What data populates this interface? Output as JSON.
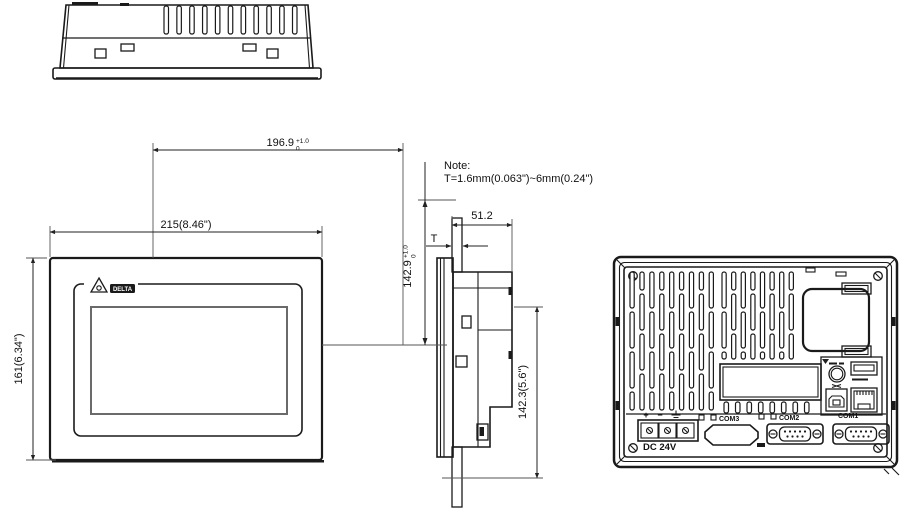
{
  "note": {
    "line1": "Note:",
    "line2": "T=1.6mm(0.063\")~6mm(0.24\")"
  },
  "dimensions": {
    "cutout_width": {
      "value": "196.9",
      "tol_upper": "+1.0",
      "tol_lower": "0"
    },
    "cutout_height": {
      "value": "142.9",
      "tol_upper": "+1.0",
      "tol_lower": "0"
    },
    "front_width": "215(8.46\")",
    "front_height": "161(6.34\")",
    "side_depth": "51.2",
    "panel_thickness": "T",
    "body_height": "142.3(5.6\")"
  },
  "front_view": {
    "brand": "DELTA"
  },
  "rear_view": {
    "power_label": "DC 24V",
    "terminal_plus": "+",
    "terminal_minus": "−",
    "port_com1": "COM1",
    "port_com2": "COM2",
    "port_com3": "COM3"
  },
  "colors": {
    "line": "#1a1a1a",
    "dim": "#222222",
    "screen_border": "#6a6a6a"
  }
}
